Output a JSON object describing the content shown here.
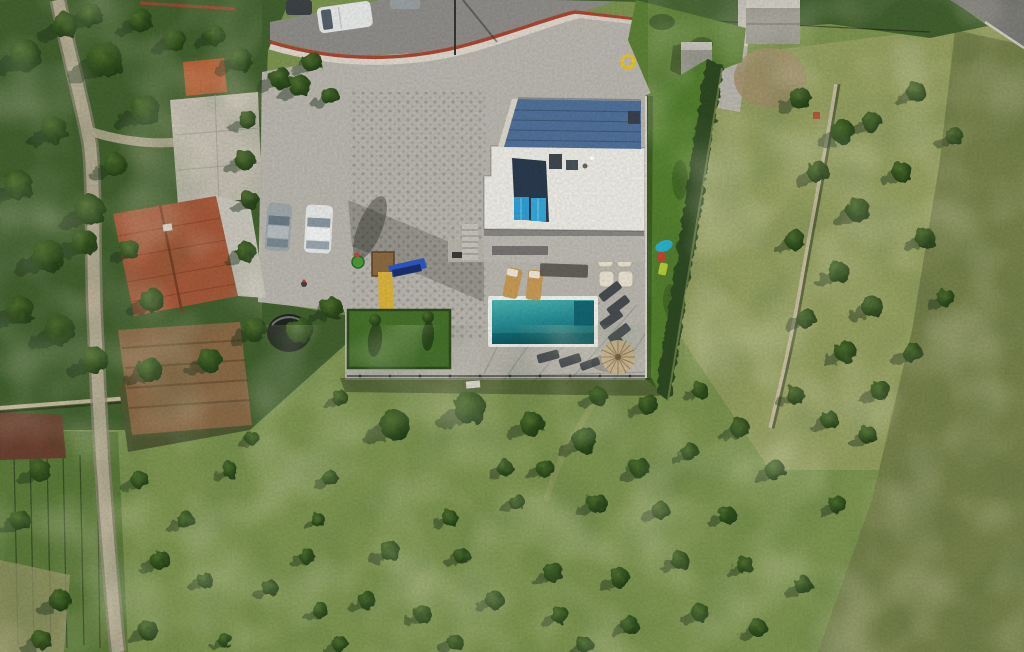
{
  "meta": {
    "description": "Aerial drone photograph, top-down view: a modern white flat-roofed villa with turquoise swimming pool and paved terrace, neighbouring house with red tiled roof, parked cars, playground with slides, lawns, hedges, stone walls, country roads and hillside olive groves with scattered trees."
  },
  "scene": {
    "objects": [
      {
        "name": "villa",
        "label": "modern white villa with flat roof"
      },
      {
        "name": "roof-deck",
        "label": "blue-grey upper roof deck"
      },
      {
        "name": "solar-panels",
        "label": "rooftop solar panels"
      },
      {
        "name": "pool",
        "label": "rectangular turquoise swimming pool"
      },
      {
        "name": "pool-terrace",
        "label": "paved pool terrace with loungers and straw umbrella"
      },
      {
        "name": "playground",
        "label": "playground with yellow and blue slides"
      },
      {
        "name": "red-roof-house",
        "label": "neighbouring house with red tiled roof"
      },
      {
        "name": "parking",
        "label": "cobbled driveway with two parked cars"
      },
      {
        "name": "road",
        "label": "asphalt road along the top with parked van"
      },
      {
        "name": "olive-grove",
        "label": "hillside olive grove with stone wall"
      },
      {
        "name": "field",
        "label": "large green field dotted with olive trees"
      },
      {
        "name": "country-lane",
        "label": "narrow country lane on the left"
      }
    ],
    "counts": {
      "cars_driveway": 2,
      "vehicles_on_road": 2,
      "solar_panels": 2,
      "tan_sun_loungers": 2,
      "dark_sun_loungers": 8,
      "cream_lounge_chairs": 4,
      "umbrellas": 1,
      "pools": 1
    }
  },
  "colors": {
    "field_green": "#7d9450",
    "grove_grass": "#95a061",
    "scrub": "#76814b",
    "veg_dark": "#42602e",
    "grass_wedge": "#5d8136",
    "lawn": "#55802e",
    "lawn_patch": "#46712a",
    "hedge": "#2e4a21",
    "tree_shadow": "#1c3314",
    "terrace": "#b9b6ae",
    "road": "#8e8d89",
    "road_dark": "#7c7b77",
    "path": "#b5ac94",
    "path_edge": "#8d8674",
    "wall_white": "#ddd8cc",
    "wall_red": "#ac4534",
    "roof_white": "#ecebe4",
    "deck_blue": "#50719a",
    "solar_dark": "#2b3a4e",
    "solar_bright": "#2f9fd4",
    "pool_rim": "#f2f1ec",
    "roof_red": "#a6593a",
    "house_gray": "#c9c6bc",
    "dirt": "#8a6a47",
    "dirt_light": "#a3906c",
    "tank": "#20261f",
    "car_silver": "#9fa8ab",
    "car_white": "#e7e9e8",
    "lounger_tan": "#c79a56",
    "lounger_dark": "#474c50",
    "chair_cream": "#e8e2d2",
    "umbrella": "#c9b28d",
    "toy_cyan": "#29b6d8",
    "toy_red": "#cf4434",
    "toy_green": "#bcd23a",
    "ring_yellow": "#e5c32b",
    "shed_red": "#b35c31",
    "vineyard": "#5d7b3a",
    "burnt": "#6b4030",
    "stone_wall": "#c6bb9f",
    "concrete": "#9c9a92"
  },
  "trees": {
    "field": [
      [
        340,
        398,
        8
      ],
      [
        470,
        408,
        16
      ],
      [
        598,
        396,
        9
      ],
      [
        648,
        404,
        10
      ],
      [
        700,
        390,
        8
      ],
      [
        395,
        425,
        15
      ],
      [
        532,
        424,
        12
      ],
      [
        585,
        440,
        13
      ],
      [
        740,
        428,
        10
      ],
      [
        252,
        438,
        7
      ],
      [
        330,
        478,
        8
      ],
      [
        505,
        468,
        8
      ],
      [
        545,
        468,
        9
      ],
      [
        640,
        468,
        10
      ],
      [
        690,
        452,
        9
      ],
      [
        775,
        470,
        10
      ],
      [
        318,
        520,
        7
      ],
      [
        450,
        518,
        8
      ],
      [
        517,
        502,
        8
      ],
      [
        597,
        503,
        10
      ],
      [
        660,
        510,
        9
      ],
      [
        727,
        515,
        9
      ],
      [
        838,
        505,
        9
      ],
      [
        307,
        556,
        8
      ],
      [
        390,
        551,
        10
      ],
      [
        462,
        556,
        8
      ],
      [
        553,
        572,
        10
      ],
      [
        620,
        578,
        10
      ],
      [
        680,
        560,
        9
      ],
      [
        745,
        565,
        9
      ],
      [
        803,
        585,
        9
      ],
      [
        270,
        588,
        8
      ],
      [
        320,
        610,
        8
      ],
      [
        367,
        600,
        9
      ],
      [
        423,
        614,
        9
      ],
      [
        495,
        600,
        9
      ],
      [
        560,
        615,
        9
      ],
      [
        630,
        625,
        9
      ],
      [
        700,
        612,
        9
      ],
      [
        758,
        628,
        9
      ],
      [
        225,
        640,
        7
      ],
      [
        340,
        644,
        8
      ],
      [
        455,
        642,
        8
      ],
      [
        585,
        645,
        8
      ]
    ],
    "grove": [
      [
        800,
        98,
        11
      ],
      [
        843,
        132,
        12
      ],
      [
        818,
        172,
        11
      ],
      [
        858,
        210,
        12
      ],
      [
        795,
        240,
        10
      ],
      [
        838,
        272,
        11
      ],
      [
        872,
        306,
        11
      ],
      [
        806,
        318,
        10
      ],
      [
        846,
        352,
        11
      ],
      [
        880,
        390,
        10
      ],
      [
        902,
        172,
        10
      ],
      [
        925,
        238,
        10
      ],
      [
        946,
        298,
        9
      ],
      [
        912,
        352,
        10
      ],
      [
        872,
        122,
        10
      ],
      [
        916,
        92,
        10
      ],
      [
        954,
        136,
        9
      ],
      [
        795,
        395,
        9
      ],
      [
        830,
        420,
        9
      ],
      [
        868,
        435,
        9
      ]
    ],
    "left": [
      [
        25,
        55,
        16
      ],
      [
        65,
        25,
        13
      ],
      [
        105,
        60,
        18
      ],
      [
        145,
        110,
        15
      ],
      [
        55,
        130,
        13
      ],
      [
        18,
        185,
        15
      ],
      [
        48,
        255,
        16
      ],
      [
        115,
        165,
        12
      ],
      [
        20,
        310,
        14
      ],
      [
        60,
        330,
        15
      ],
      [
        130,
        250,
        10
      ],
      [
        152,
        300,
        12
      ],
      [
        240,
        60,
        12
      ],
      [
        215,
        35,
        10
      ],
      [
        175,
        40,
        11
      ],
      [
        140,
        20,
        12
      ],
      [
        90,
        15,
        12
      ],
      [
        280,
        78,
        11
      ],
      [
        312,
        62,
        10
      ],
      [
        248,
        120,
        9
      ],
      [
        245,
        160,
        10
      ],
      [
        250,
        200,
        9
      ],
      [
        246,
        252,
        10
      ],
      [
        300,
        86,
        11
      ],
      [
        330,
        96,
        9
      ],
      [
        95,
        360,
        13
      ],
      [
        150,
        370,
        12
      ],
      [
        210,
        360,
        12
      ],
      [
        255,
        330,
        12
      ],
      [
        300,
        330,
        13
      ],
      [
        332,
        308,
        11
      ],
      [
        90,
        210,
        15
      ],
      [
        84,
        242,
        13
      ]
    ],
    "bottomleft": [
      [
        40,
        470,
        11
      ],
      [
        20,
        520,
        10
      ],
      [
        60,
        600,
        11
      ],
      [
        140,
        480,
        9
      ],
      [
        160,
        560,
        10
      ],
      [
        42,
        640,
        10
      ],
      [
        148,
        630,
        10
      ],
      [
        185,
        520,
        9
      ],
      [
        205,
        580,
        8
      ],
      [
        230,
        470,
        8
      ]
    ]
  }
}
